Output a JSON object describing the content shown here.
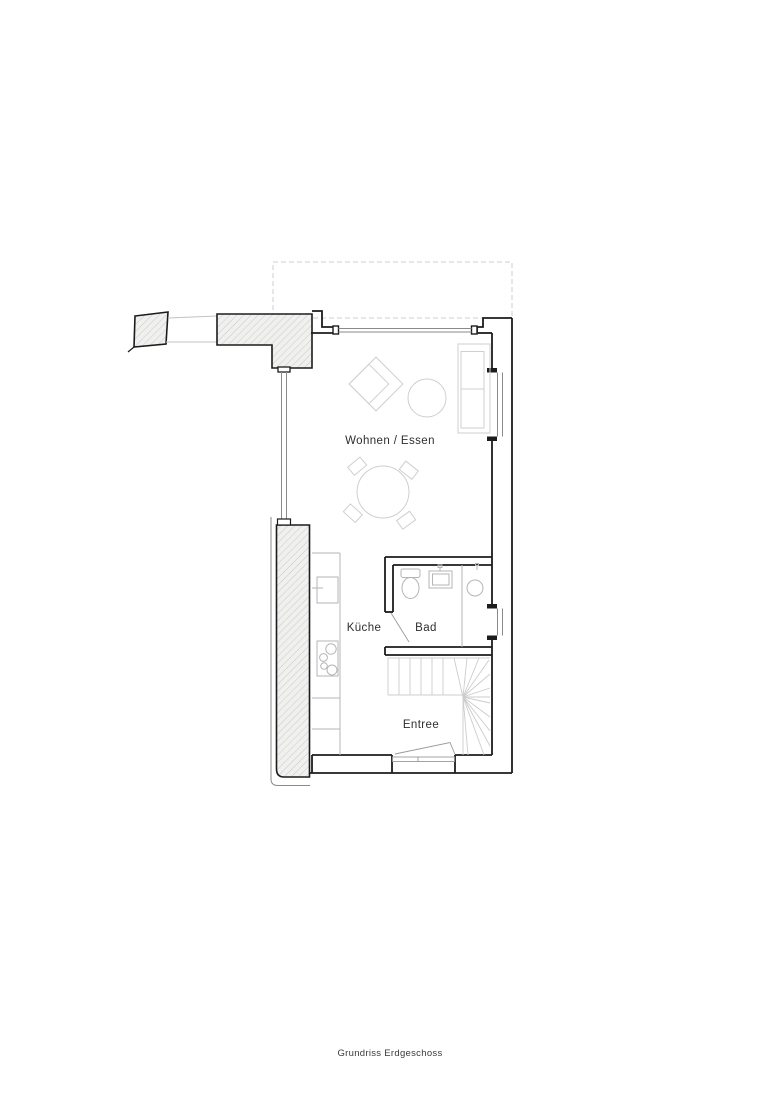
{
  "document": {
    "caption": "Grundriss Erdgeschoss"
  },
  "floorplan": {
    "rooms": {
      "living_dining": "Wohnen / Essen",
      "kitchen": "Küche",
      "bath": "Bad",
      "entry": "Entree"
    },
    "elements": {
      "existing_walls": "hatched-existing-masonry",
      "upper_outline": "dashed-upper-storey-outline",
      "stairs": "winder-staircase",
      "windows": [
        "top-window-band",
        "right-living-window",
        "right-bath-window",
        "left-glazing-band"
      ],
      "doors": [
        "entrance-door",
        "bathroom-door"
      ],
      "furniture": [
        "sofa",
        "armchair",
        "side-table",
        "dining-table",
        "dining-chairs"
      ],
      "fixtures": [
        "toilet",
        "washbasin",
        "shower",
        "kitchen-sink",
        "cooktop",
        "kitchen-counter"
      ]
    },
    "colors": {
      "wall": "#1c1c1c",
      "existing_wall_fill": "#f0f0ef",
      "hatch_line": "#c9c9c9",
      "furniture": "#cfcfcf",
      "fixture": "#b5b5b5",
      "stair_line": "#cccccc",
      "dashed_outline": "#cfcfcf",
      "text": "#2e2e2e",
      "background": "#ffffff"
    }
  }
}
